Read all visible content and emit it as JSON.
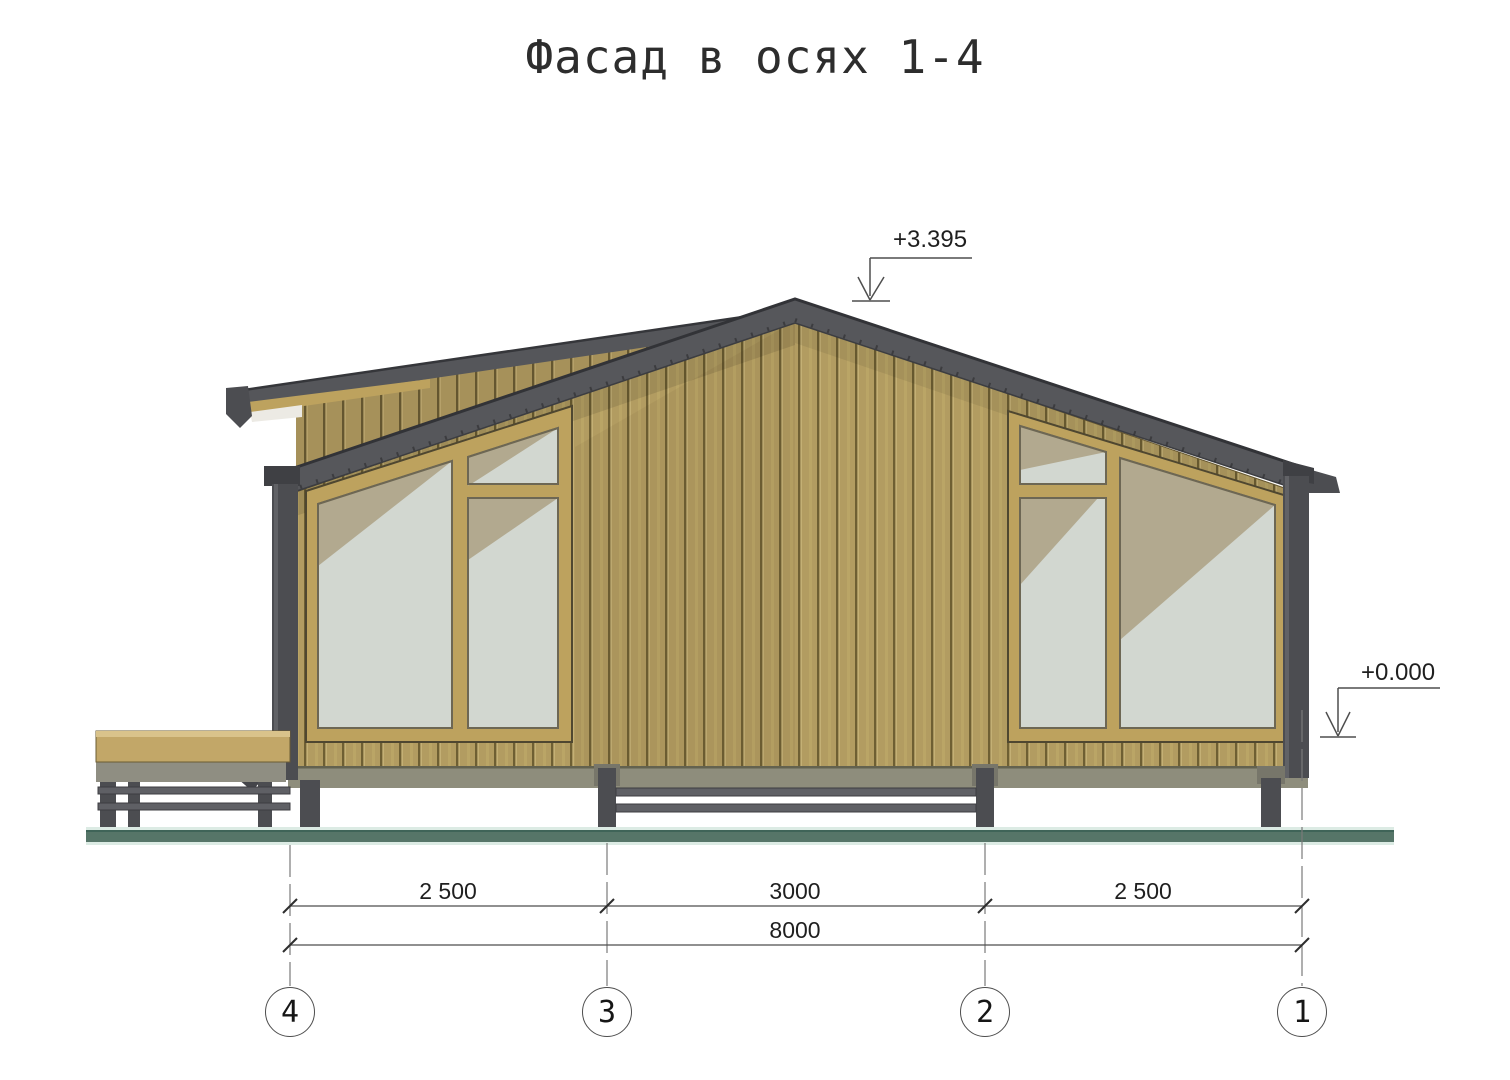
{
  "title": "Фасад в осях 1-4",
  "drawing": {
    "type": "architectural-facade-elevation",
    "levels": {
      "ridge": "+3.395",
      "floor": "+0.000"
    },
    "dimensions": {
      "segments": [
        "2 500",
        "3000",
        "2 500"
      ],
      "total": "8000"
    },
    "axes": [
      "4",
      "3",
      "2",
      "1"
    ],
    "colors": {
      "siding": "#b29c61",
      "siding_groove": "#6e5f33",
      "roof": "#56575b",
      "roof_edge": "#323337",
      "window_frame": "#bda25e",
      "glass": "#d2d7d0",
      "glass_reflection": "#b2a98f",
      "structure_gray": "#4c4d51",
      "rim_band": "#8e8d7c",
      "ground": "#567568",
      "annotation": "#555555"
    }
  }
}
